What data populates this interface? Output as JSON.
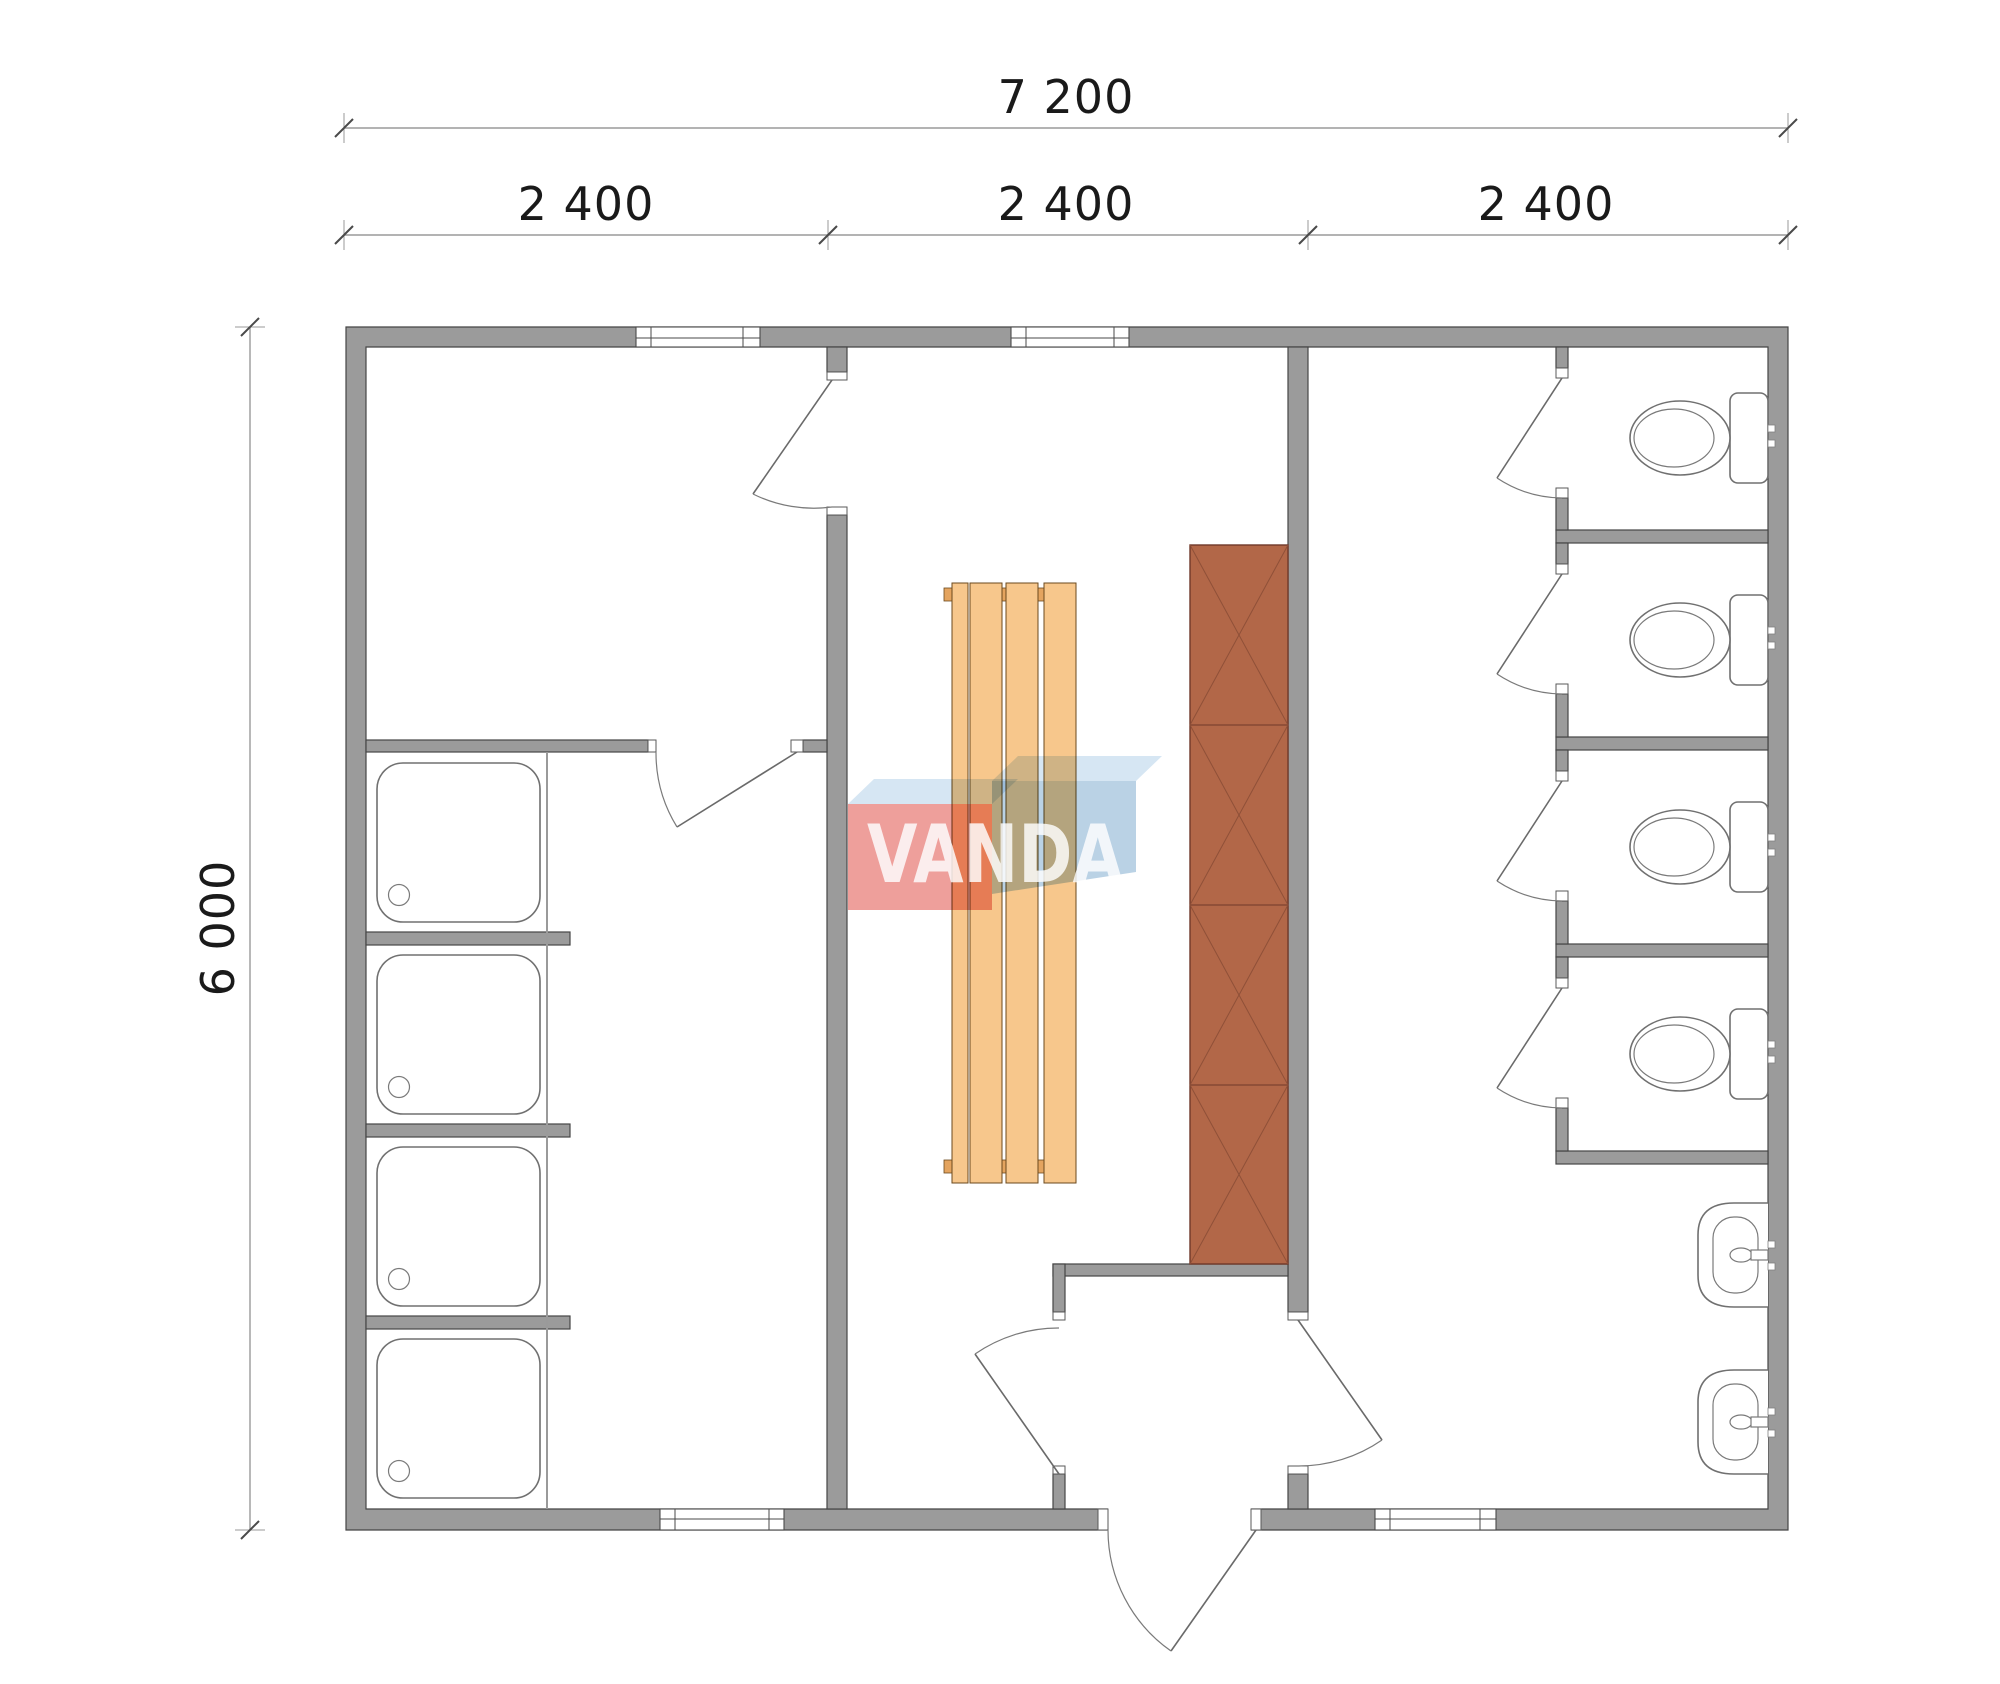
{
  "dimensions": {
    "total_width_label": "7 200",
    "module_labels": [
      "2 400",
      "2 400",
      "2 400"
    ],
    "total_height_label": "6 000"
  },
  "watermark": {
    "text": "VANDA"
  },
  "colors": {
    "wall": "#9b9b9b",
    "wall_outline": "#454545",
    "bench": "#f7c78c",
    "bench_edge": "#6b4a1e",
    "cabinet": "#b26748",
    "watermark_red": "#dd4037",
    "watermark_blue": "#76a6cc",
    "watermark_pale_blue": "#add0e8",
    "dimension_text": "#1a1a1a",
    "background": "#ffffff"
  },
  "fixtures": {
    "shower_trays": 4,
    "toilet_stalls": 4,
    "wash_basins": 2,
    "bench_slats": 4,
    "cabinet_sections": 4,
    "windows": 4,
    "doors": 10
  }
}
